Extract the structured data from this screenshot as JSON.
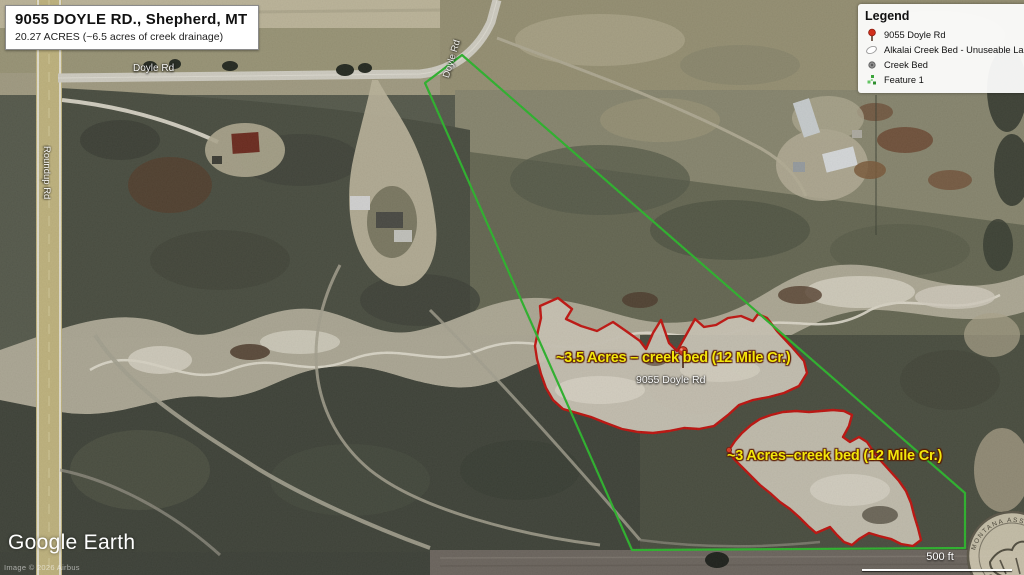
{
  "title_box": {
    "line1": "9055 DOYLE RD., Shepherd, MT",
    "line2": "20.27 ACRES (~6.5 acres of creek drainage)"
  },
  "legend": {
    "title": "Legend",
    "items": [
      {
        "icon": "pushpin-icon",
        "label": "9055 Doyle Rd"
      },
      {
        "icon": "polygon-outline-icon",
        "label": "Alkalai Creek Bed - Unuseable Land"
      },
      {
        "icon": "dot-icon",
        "label": "Creek Bed"
      },
      {
        "icon": "feature-cluster-icon",
        "label": "Feature 1"
      }
    ]
  },
  "map_labels": {
    "road_doyle_top": "Doyle Rd",
    "road_doyle_curve": "Doyle Rd",
    "road_roundup": "Roundup Rd",
    "property_pin": "9055 Doyle Rd",
    "annotation_upper": "~3.5 Acres – creek bed (12 Mile Cr.)",
    "annotation_lower": "~3 Acres–creek bed (12 Mile Cr.)"
  },
  "attribution": {
    "logo": "Google Earth",
    "imagery_credit": "Image © 2026 Airbus"
  },
  "scale_bar": {
    "label": "500 ft"
  },
  "watermark": {
    "ring_text_top": "MONTANA ASSOCIATION",
    "ring_text_bottom": "OF REALTORS"
  },
  "colors": {
    "boundary_green": "#2db92d",
    "creek_outline_red": "#c8100c",
    "annotation_yellow": "#f2e70b",
    "pin_red": "#e03b22"
  }
}
